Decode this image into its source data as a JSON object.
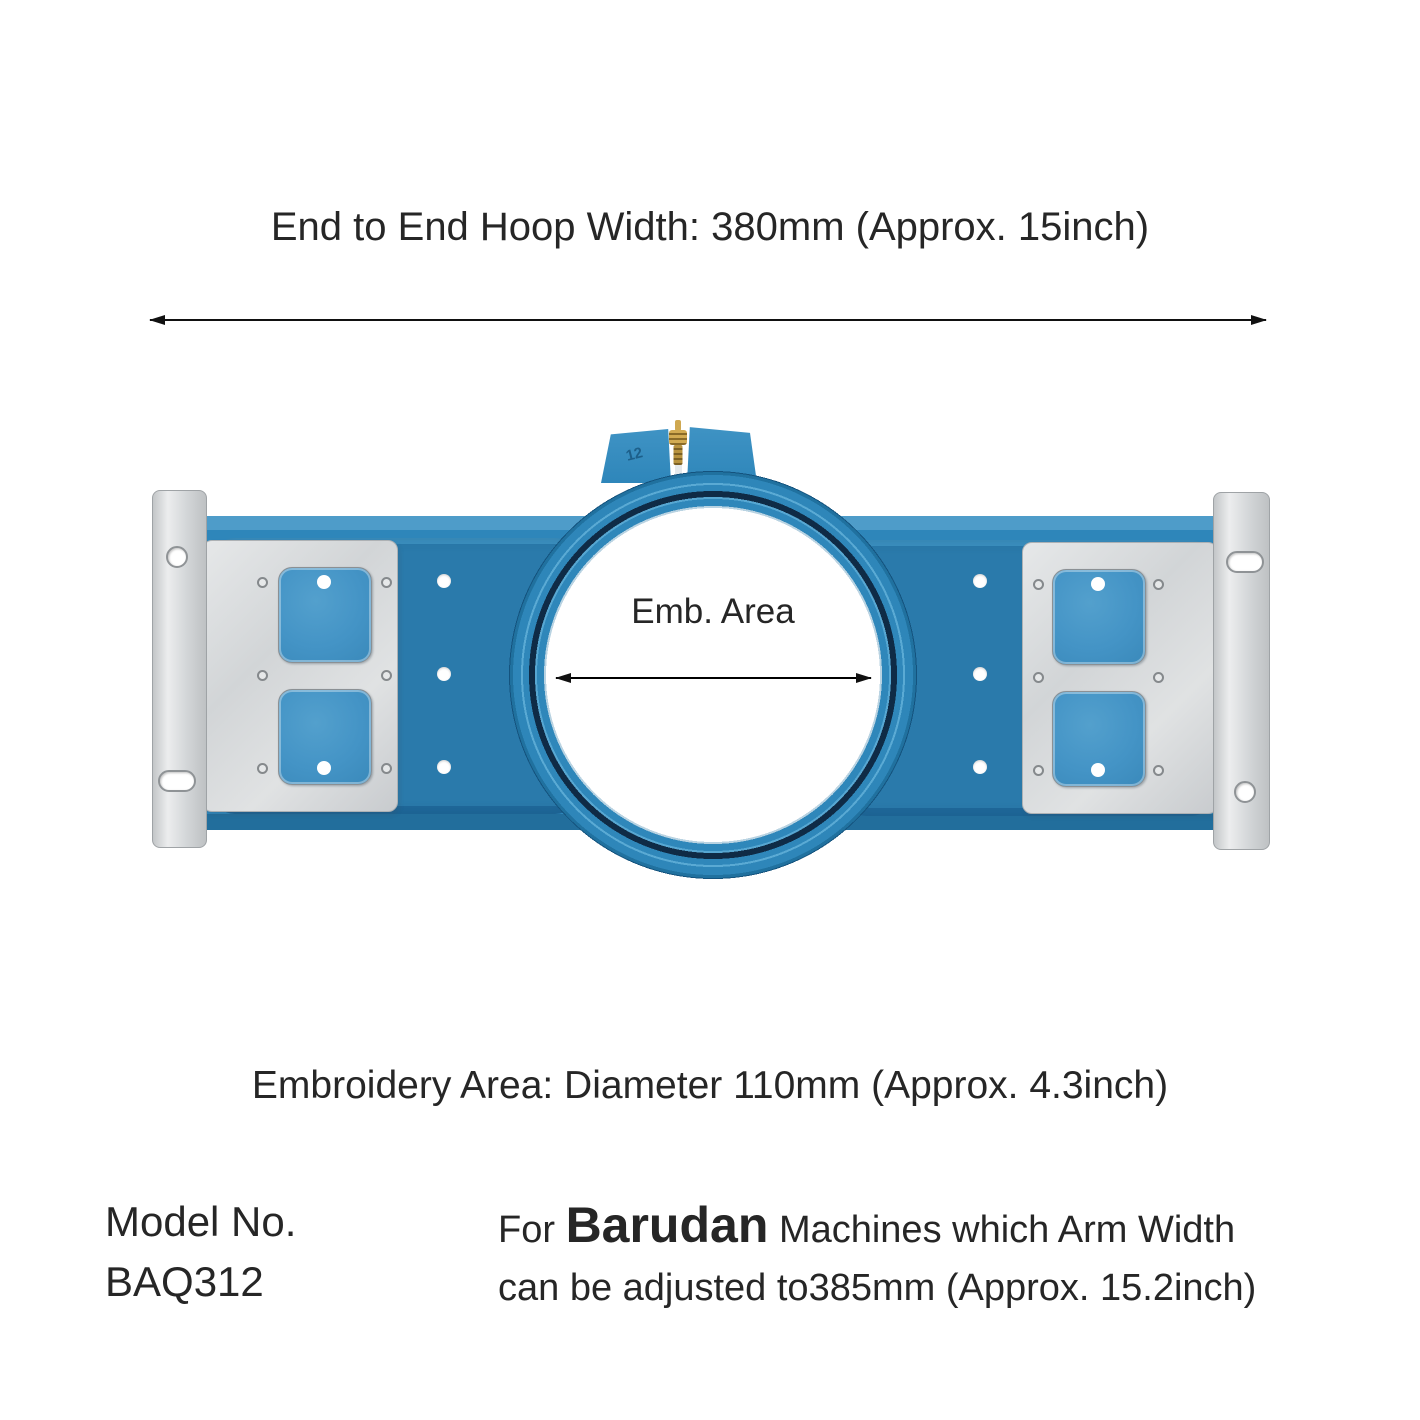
{
  "annotations": {
    "hoop_width": {
      "label": "End to End Hoop Width: 380mm (Approx. 15inch)"
    },
    "emb_area": {
      "label": "Emb. Area"
    },
    "emb_diameter": {
      "label": "Embroidery Area: Diameter 110mm (Approx. 4.3inch)"
    }
  },
  "product": {
    "size_marking": "12"
  },
  "model": {
    "label": "Model No.",
    "number": "BAQ312"
  },
  "compatibility": {
    "prefix": "For",
    "brand": "Barudan",
    "suffix": "Machines which Arm Width",
    "line2": "can be adjusted to385mm (Approx. 15.2inch)"
  },
  "colors": {
    "frame_blue": "#2e86ba",
    "recess_blue": "#2a7aab",
    "window_blue": "#4494c6",
    "groove_navy": "#0f2b46",
    "metal_silver": "#d9dbdc",
    "brass": "#bd9a47",
    "annotation_text": "#262626",
    "background": "#ffffff"
  }
}
